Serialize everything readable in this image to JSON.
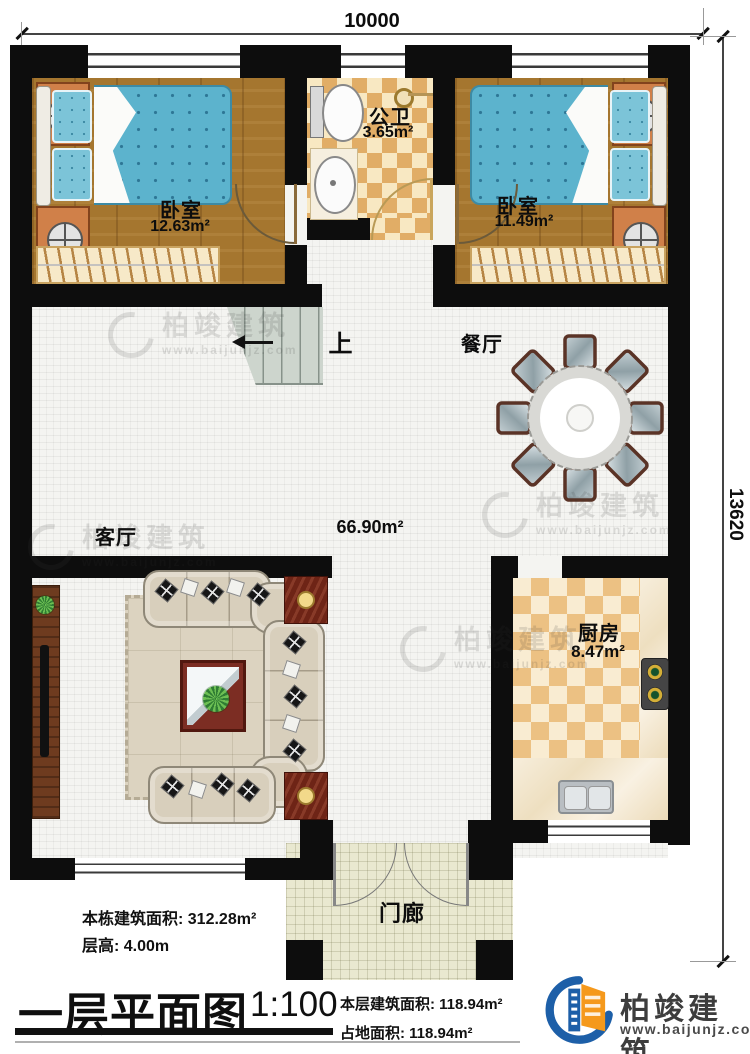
{
  "dimensions": {
    "width_label": "10000",
    "height_label": "13620"
  },
  "rooms": {
    "bedroom_left": {
      "name": "卧室",
      "area": "12.63m²"
    },
    "bathroom": {
      "name": "公卫",
      "area": "3.65m²"
    },
    "bedroom_right": {
      "name": "卧室",
      "area": "11.49m²"
    },
    "dining": {
      "name": "餐厅"
    },
    "living": {
      "name": "客厅"
    },
    "hall": {
      "area": "66.90m²"
    },
    "kitchen": {
      "name": "厨房",
      "area": "8.47m²"
    },
    "porch": {
      "name": "门廊"
    },
    "stairs": {
      "direction_label": "上"
    }
  },
  "annotations": {
    "building_area_label": "本栋建筑面积: 312.28m²",
    "floor_height_label": "层高: 4.00m"
  },
  "title_block": {
    "title": "一层平面图",
    "scale": "1:100",
    "floor_area_label": "本层建筑面积: 118.94m²",
    "footprint_label": "占地面积: 118.94m²"
  },
  "branding": {
    "company": "柏竣建筑",
    "website": "www.baijunjz.com"
  },
  "colors": {
    "wall": "#0d0d0d",
    "wood_floor": "#a5762f",
    "bathroom_tile": "#e1ad66",
    "kitchen_tile": "#ecc183",
    "mattress_blue": "#5cb3cd",
    "brand_blue": "#1d5fa8",
    "brand_orange": "#f5991c"
  }
}
